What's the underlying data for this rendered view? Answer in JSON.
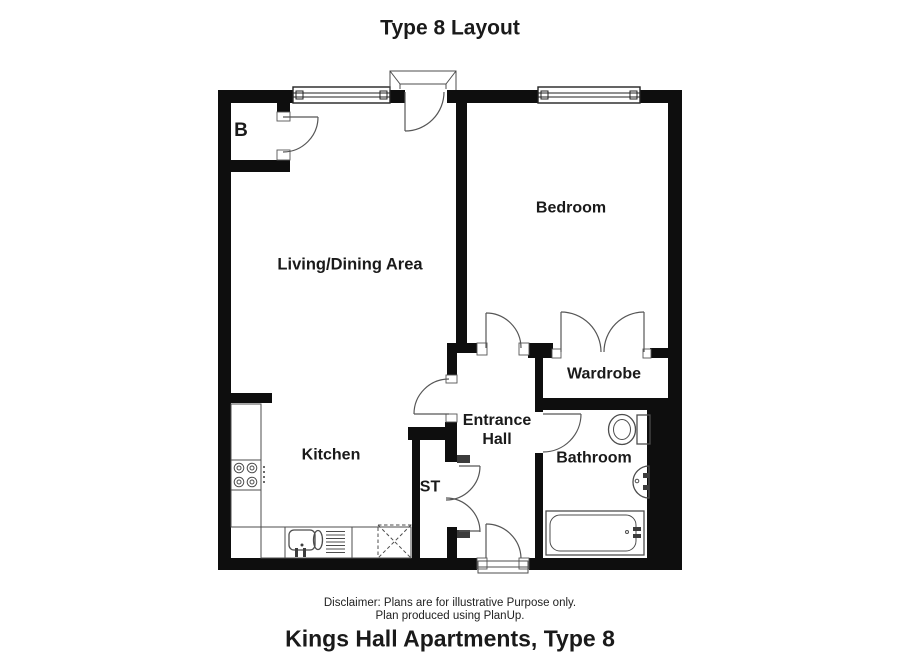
{
  "title": "Type 8 Layout",
  "rooms": {
    "b_store": {
      "label": "B"
    },
    "living_dining": {
      "label": "Living/Dining Area"
    },
    "bedroom": {
      "label": "Bedroom"
    },
    "kitchen": {
      "label": "Kitchen"
    },
    "entrance_hall": {
      "label": "Entrance Hall"
    },
    "storage": {
      "label": "ST"
    },
    "wardrobe": {
      "label": "Wardrobe"
    },
    "bathroom": {
      "label": "Bathroom"
    }
  },
  "footer": {
    "disclaimer_line1": "Disclaimer: Plans are for illustrative Purpose only.",
    "disclaimer_line2": "Plan produced using PlanUp.",
    "caption": "Kings Hall Apartments, Type 8"
  },
  "colors": {
    "wall": "#0e0e0e",
    "fixture_line": "#4d4d4d",
    "background": "#ffffff",
    "text": "#1a1a1a"
  }
}
